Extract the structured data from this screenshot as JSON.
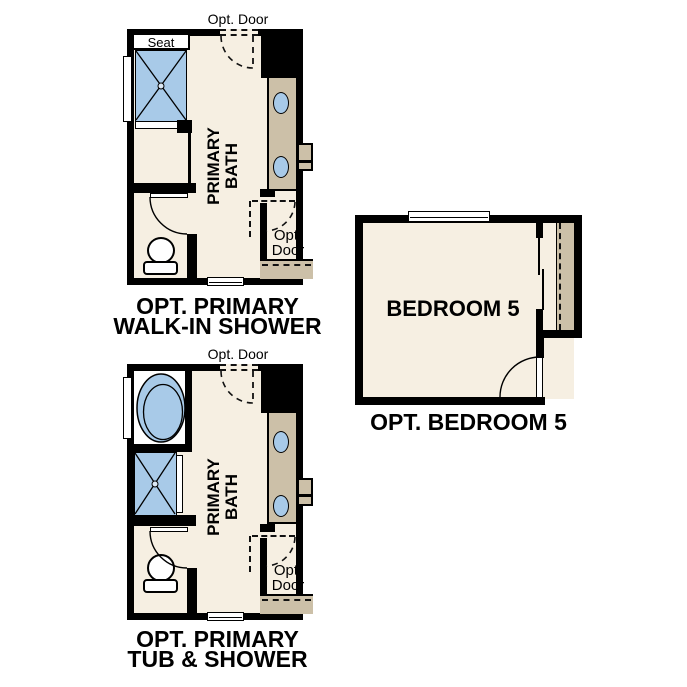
{
  "colors": {
    "wall": "#000000",
    "floor": "#F6EFE2",
    "cabinet_tan": "#CCC0A8",
    "fixture_blue": "#A8CAE8",
    "background": "#FFFFFF",
    "text": "#000000"
  },
  "plans": {
    "walk_in_shower": {
      "caption_line1": "OPT. PRIMARY",
      "caption_line2": "WALK-IN SHOWER",
      "room_label_line1": "PRIMARY",
      "room_label_line2": "BATH",
      "seat_label": "Seat",
      "opt_door_top_label": "Opt. Door",
      "opt_door_side_line1": "Opt.",
      "opt_door_side_line2": "Door"
    },
    "tub_shower": {
      "caption_line1": "OPT. PRIMARY",
      "caption_line2": "TUB & SHOWER",
      "room_label_line1": "PRIMARY",
      "room_label_line2": "BATH",
      "opt_door_top_label": "Opt. Door",
      "opt_door_side_line1": "Opt.",
      "opt_door_side_line2": "Door"
    },
    "bedroom5": {
      "room_label": "BEDROOM 5",
      "caption": "OPT. BEDROOM 5"
    }
  }
}
